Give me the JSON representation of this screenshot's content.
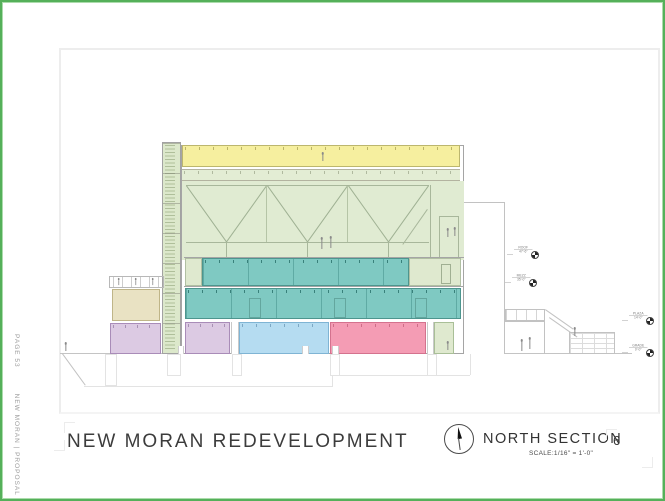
{
  "sidebar": {
    "page_label": "PAGE 53",
    "project_label": "NEW MORAN | PROPOSAL"
  },
  "titleblock": {
    "title": "NEW MORAN REDEVELOPMENT",
    "section": "NORTH SECTION",
    "scale": "SCALE:1/16\" = 1'-0\"",
    "page_number": "6"
  },
  "drawing": {
    "type": "architectural-section",
    "elevation_markers": [
      {
        "label": "ROOF",
        "elev": "47'-6\""
      },
      {
        "label": "MEZZ",
        "elev": "35'-0\""
      },
      {
        "label": "PLAZA",
        "elev": "14'-0\""
      },
      {
        "label": "GRADE",
        "elev": "0'-0\""
      }
    ],
    "colors": {
      "frame_green": "#55b05a",
      "roof_band": "#f6ef9f",
      "hall_green": "#e0ebd2",
      "stair_green": "#dce8cb",
      "floor_teal": "#7fc9c2",
      "room_lavender": "#dccae3",
      "room_blue": "#b5dcf1",
      "room_pink": "#f49cb4",
      "room_tan": "#e9e2c3"
    }
  }
}
